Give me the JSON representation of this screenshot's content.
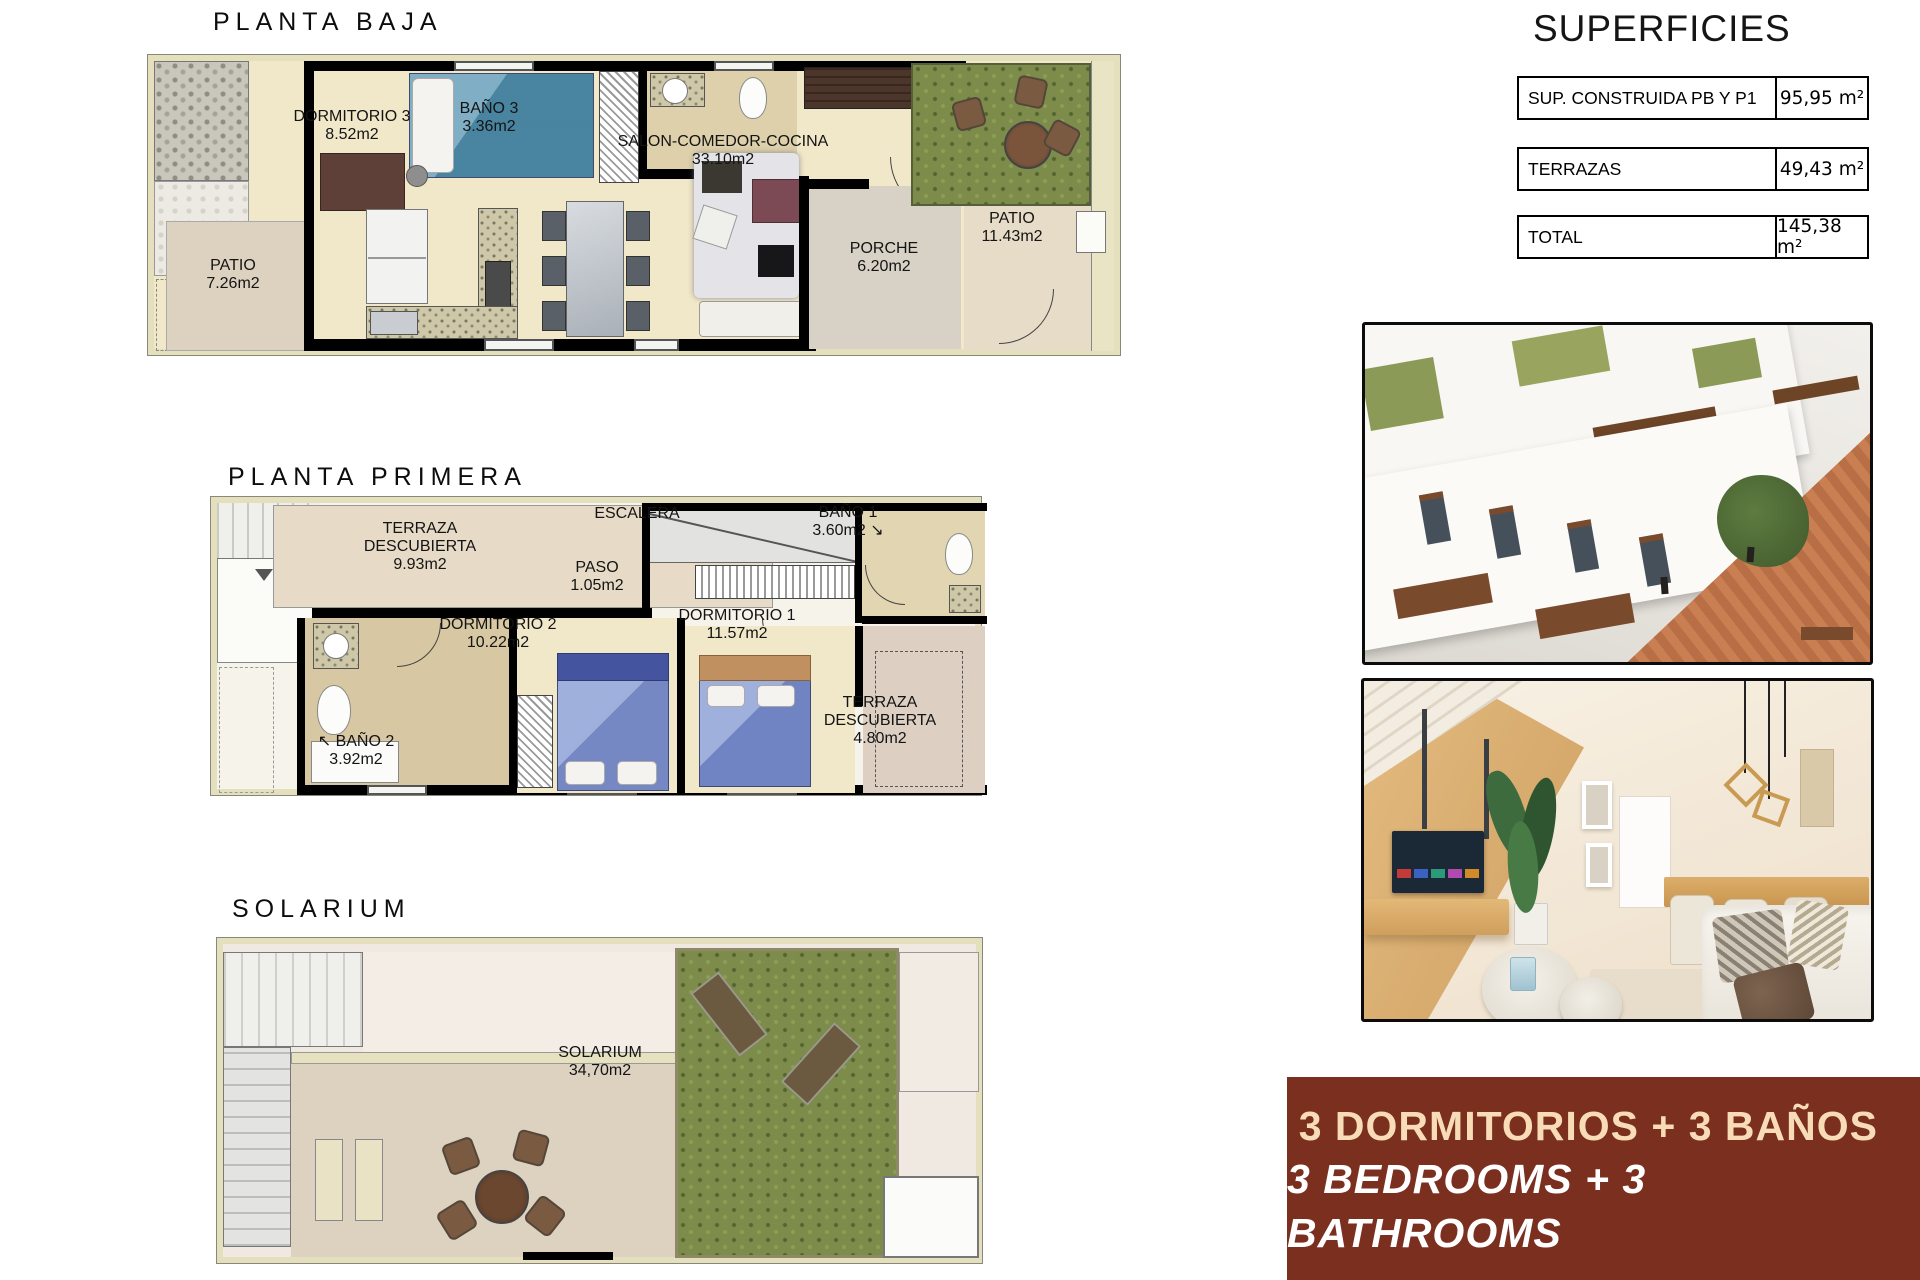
{
  "plans": {
    "pb": {
      "title": "PLANTA BAJA",
      "rooms": [
        {
          "name": "DORMITORIO 3",
          "area": "8.52m2"
        },
        {
          "name": "BAÑO 3",
          "area": "3.36m2"
        },
        {
          "name": "SALON-COMEDOR-COCINA",
          "area": "33.10m2"
        },
        {
          "name": "PORCHE",
          "area": "6.20m2"
        },
        {
          "name": "PATIO",
          "area": "11.43m2"
        },
        {
          "name": "PATIO",
          "area": "7.26m2"
        }
      ]
    },
    "p1": {
      "title": "PLANTA PRIMERA",
      "rooms": [
        {
          "name": "TERRAZA DESCUBIERTA",
          "area": "9.93m2"
        },
        {
          "name": "ESCALERA",
          "area": ""
        },
        {
          "name": "PASO",
          "area": "1.05m2"
        },
        {
          "name": "BAÑO 1",
          "area": "3.60m2 ↘"
        },
        {
          "name": "DORMITORIO 2",
          "area": "10.22m2"
        },
        {
          "name": "DORMITORIO 1",
          "area": "11.57m2"
        },
        {
          "name": "TERRAZA DESCUBIERTA",
          "area": "4.80m2"
        },
        {
          "name": "↖ BAÑO 2",
          "area": "3.92m2"
        }
      ]
    },
    "sol": {
      "title": "SOLARIUM",
      "rooms": [
        {
          "name": "SOLARIUM",
          "area": "34,70m2"
        }
      ]
    }
  },
  "superficies": {
    "title": "SUPERFICIES",
    "rows": [
      {
        "label": "SUP. CONSTRUIDA PB Y P1",
        "value": "95,95 m²"
      },
      {
        "label": "TERRAZAS",
        "value": "49,43 m²"
      },
      {
        "label": "TOTAL",
        "value": "145,38 m²"
      }
    ]
  },
  "banner": {
    "line1": "3 DORMITORIOS + 3 BAÑOS",
    "line2": "3 BEDROOMS + 3 BATHROOMS"
  },
  "colors": {
    "banner_bg": "#7b2f1f",
    "banner_line1": "#f8dcb8",
    "banner_line2": "#ffffff",
    "plan_floor": "#f1e7c9",
    "plan_wall": "#000000",
    "terrace_tile": "#e4d8c5",
    "grass": "#7d8c4b",
    "bed_teal": "#4f8fad",
    "bed_blue": "#8093cd"
  }
}
